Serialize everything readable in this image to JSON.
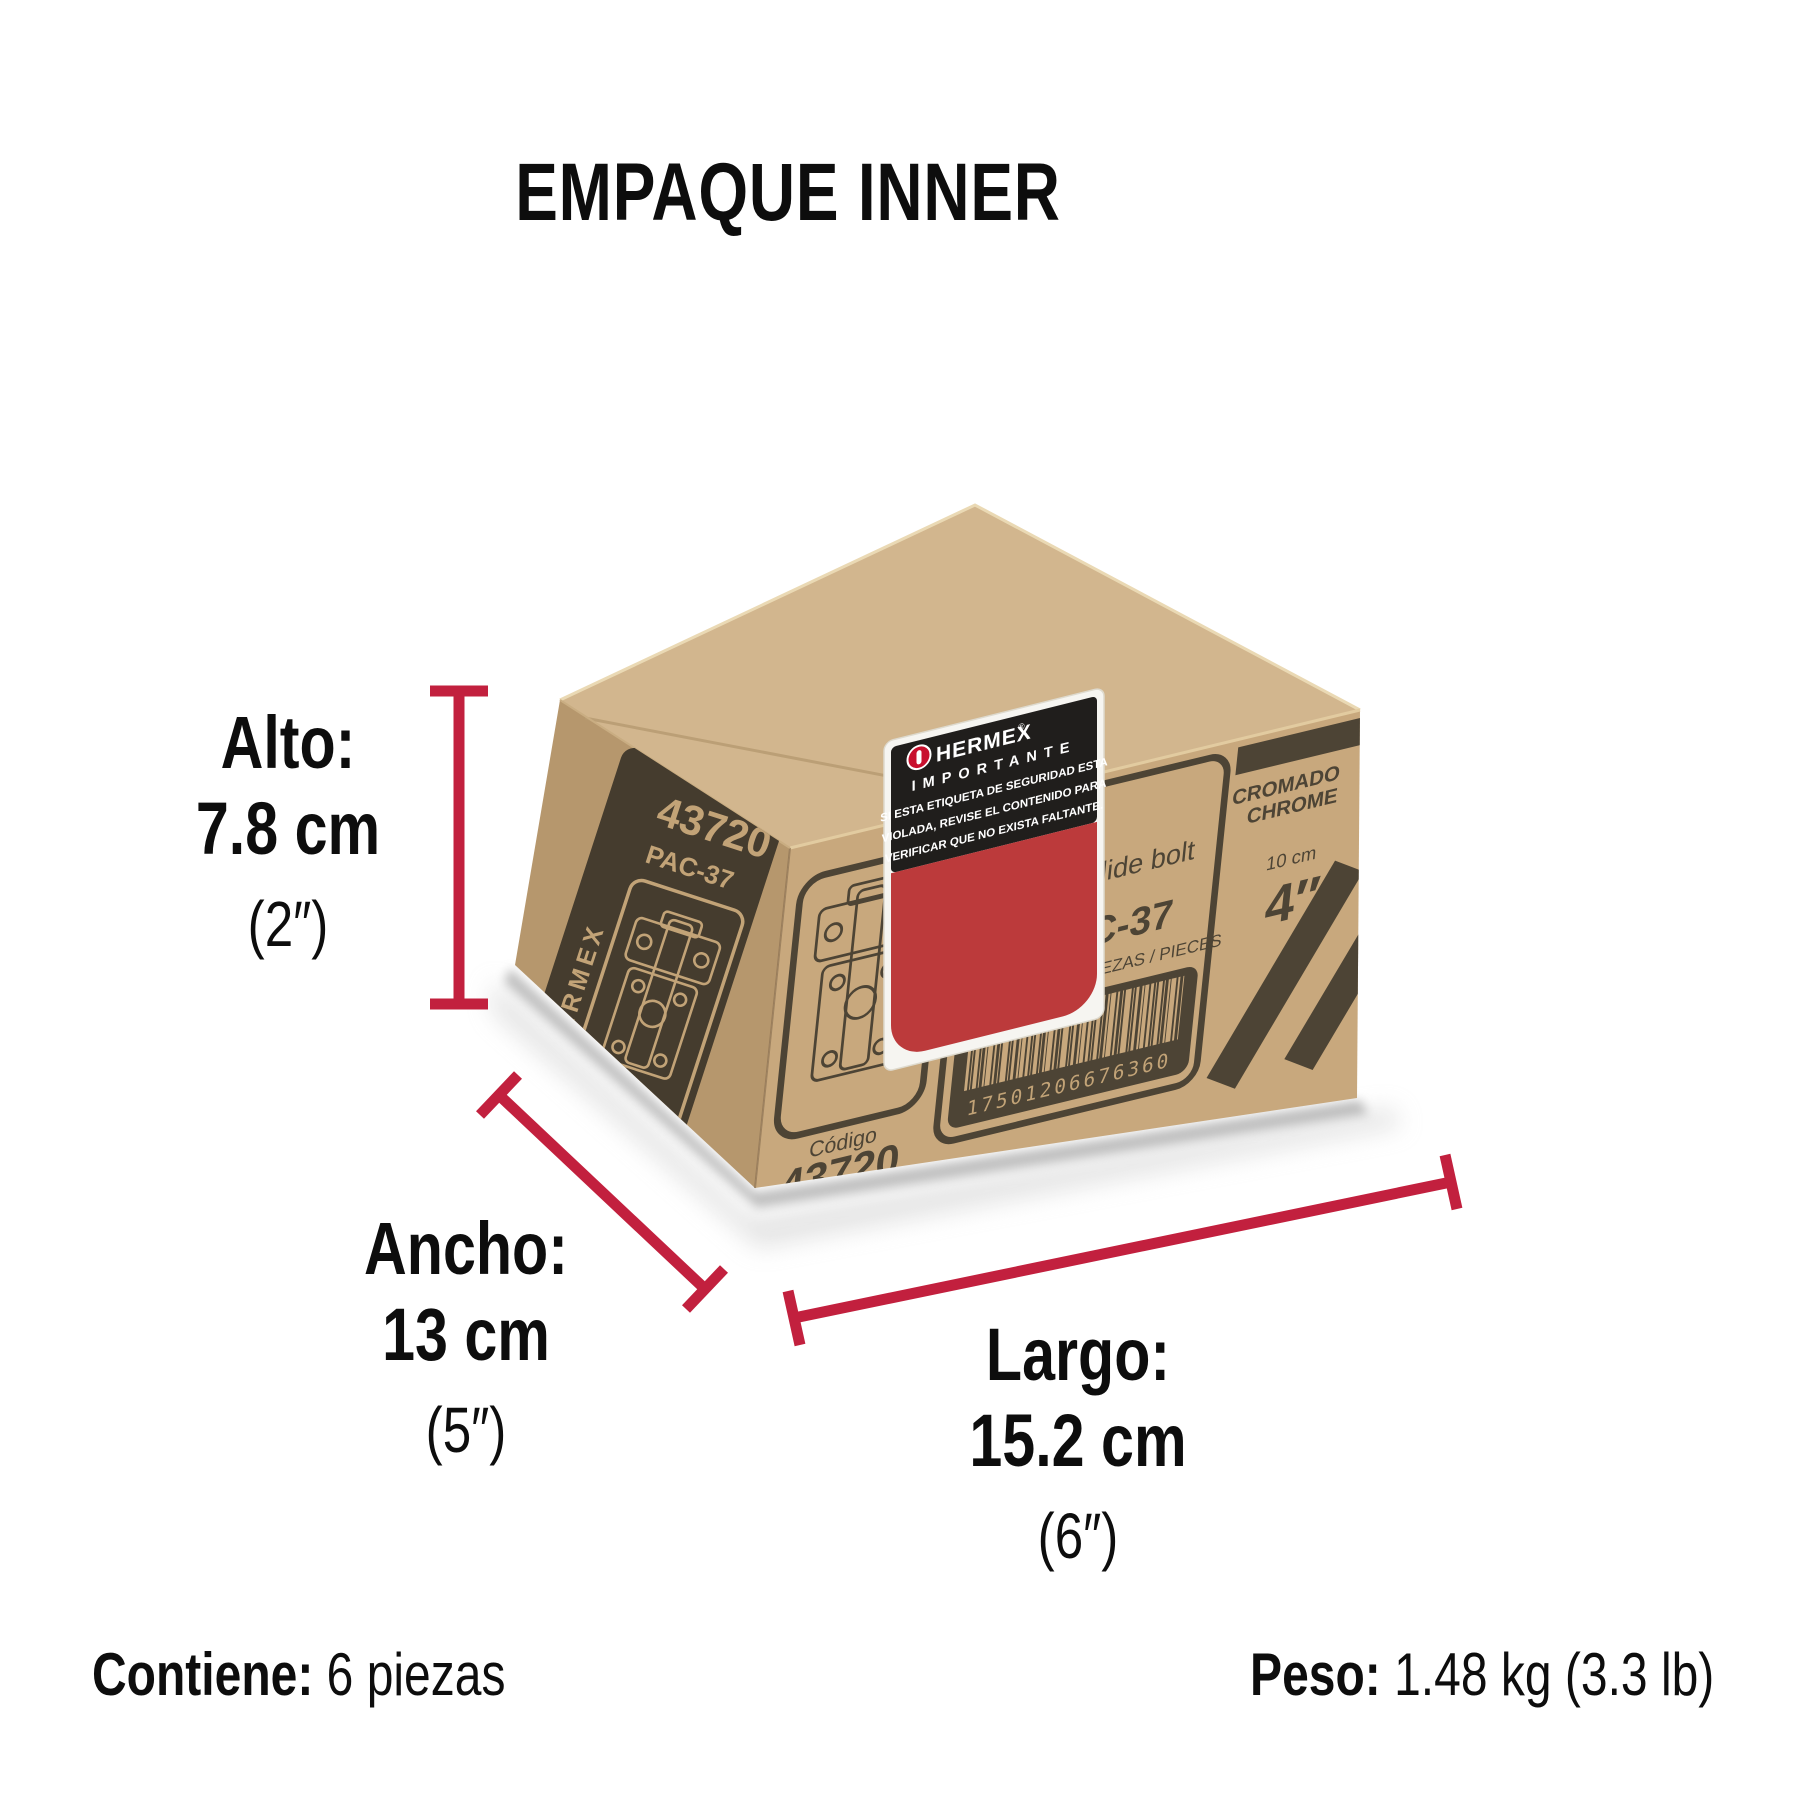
{
  "title": "EMPAQUE INNER",
  "dimensions": {
    "alto": {
      "label": "Alto:",
      "value": "7.8 cm",
      "inches": "(2″)"
    },
    "ancho": {
      "label": "Ancho:",
      "value": "13 cm",
      "inches": "(5″)"
    },
    "largo": {
      "label": "Largo:",
      "value": "15.2 cm",
      "inches": "(6″)"
    }
  },
  "footer": {
    "contains_label": "Contiene:",
    "contains_value": " 6 piezas",
    "weight_label": "Peso:",
    "weight_value": " 1.48 kg (3.3 lb)"
  },
  "box": {
    "side_panel": {
      "brand": "HERMEX",
      "code": "43720",
      "model": "PAC-37"
    },
    "front_panel": {
      "product_name_en": "Surface slide bolt",
      "clave_label": "Clave:",
      "clave_value": "PAC-37",
      "content_label": "CONT.:",
      "content_value": "6 PIEZAS / PIECES",
      "barcode_number": "17501206676360",
      "codigo_label": "Código",
      "codigo_value": "43720",
      "finish_es": "CROMADO",
      "finish_en": "CHROME",
      "size_metric": "10 cm",
      "size_imperial": "4″"
    },
    "security_sticker": {
      "brand": "HERMEX",
      "reg_mark": "®",
      "title": "IMPORTANTE",
      "line1": "SI ESTA ETIQUETA DE SEGURIDAD ESTA",
      "line2": "VIOLADA, REVISE EL CONTENIDO PARA",
      "line3": "VERIFICAR QUE NO EXISTA FALTANTE."
    }
  },
  "colors": {
    "dimension_red": "#C2203E",
    "kraft_top": "#D2B68E",
    "kraft_front": "#C8A87D",
    "kraft_side": "#B6976D",
    "print_dark": "#4D4435",
    "sticker_black": "#201E1C",
    "sticker_red": "#BC3A3B",
    "logo_red": "#C8102E"
  }
}
